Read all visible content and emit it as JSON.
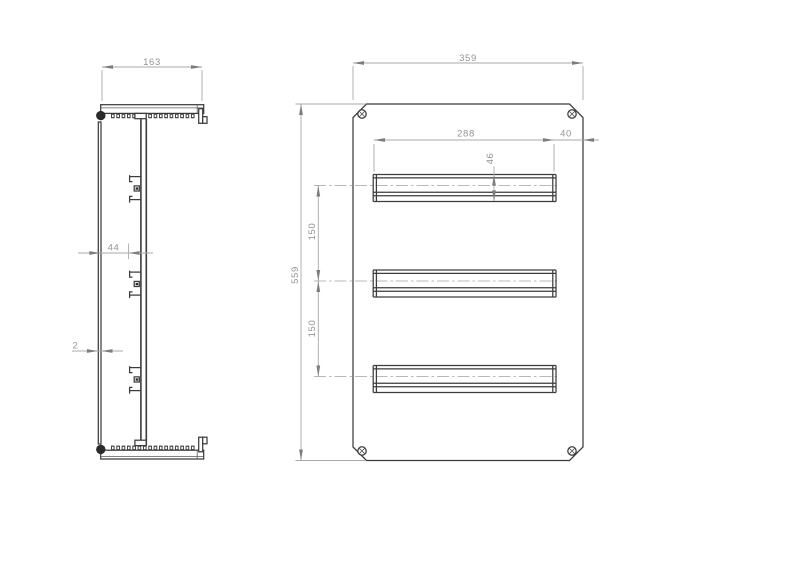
{
  "side_view": {
    "overall_width": "163",
    "din_rail_depth": "44",
    "panel_thickness": "2"
  },
  "front_view": {
    "overall_width": "359",
    "overall_height": "559",
    "din_rail_length": "288",
    "rail_edge_offset": "40",
    "rail_height": "46",
    "rail_spacing": [
      "150",
      "150"
    ]
  }
}
